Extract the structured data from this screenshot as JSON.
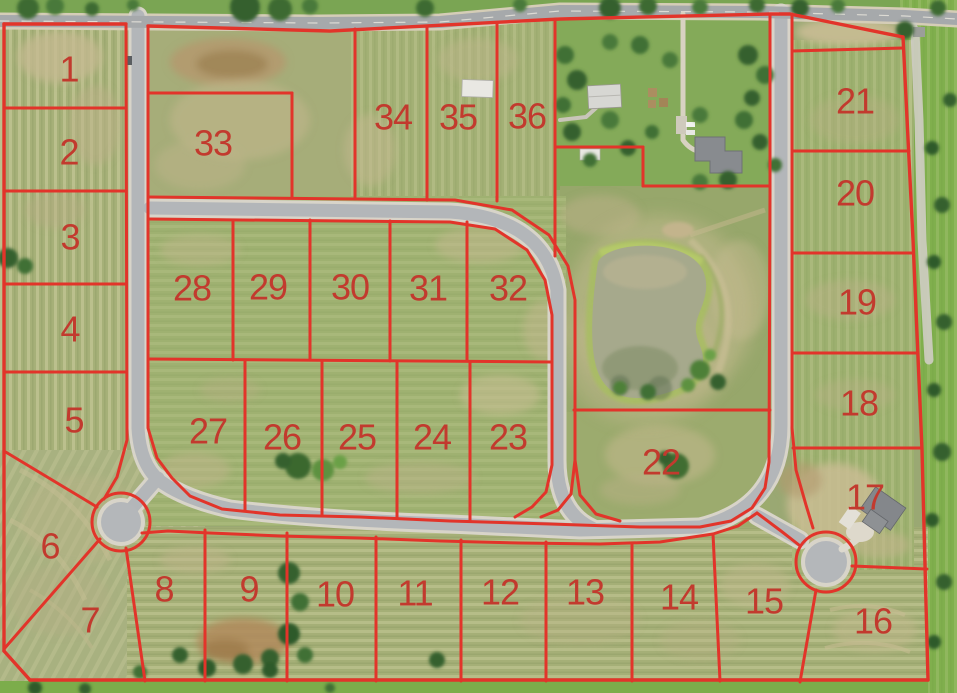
{
  "map": {
    "line_color": "#e2342a",
    "label_color": "#c23a2e",
    "label_font_px": 36,
    "lots": [
      {
        "number": "1",
        "x": 69,
        "y": 69
      },
      {
        "number": "2",
        "x": 69,
        "y": 152
      },
      {
        "number": "3",
        "x": 70,
        "y": 237
      },
      {
        "number": "4",
        "x": 70,
        "y": 329
      },
      {
        "number": "5",
        "x": 74,
        "y": 420
      },
      {
        "number": "6",
        "x": 50,
        "y": 546
      },
      {
        "number": "7",
        "x": 90,
        "y": 620
      },
      {
        "number": "8",
        "x": 164,
        "y": 589
      },
      {
        "number": "9",
        "x": 249,
        "y": 589
      },
      {
        "number": "10",
        "x": 335,
        "y": 594
      },
      {
        "number": "11",
        "x": 415,
        "y": 593
      },
      {
        "number": "12",
        "x": 500,
        "y": 592
      },
      {
        "number": "13",
        "x": 585,
        "y": 592
      },
      {
        "number": "14",
        "x": 679,
        "y": 597
      },
      {
        "number": "15",
        "x": 764,
        "y": 601
      },
      {
        "number": "16",
        "x": 873,
        "y": 621
      },
      {
        "number": "17",
        "x": 865,
        "y": 497
      },
      {
        "number": "18",
        "x": 859,
        "y": 403
      },
      {
        "number": "19",
        "x": 857,
        "y": 302
      },
      {
        "number": "20",
        "x": 855,
        "y": 193
      },
      {
        "number": "21",
        "x": 855,
        "y": 101
      },
      {
        "number": "22",
        "x": 661,
        "y": 462
      },
      {
        "number": "23",
        "x": 508,
        "y": 437
      },
      {
        "number": "24",
        "x": 432,
        "y": 437
      },
      {
        "number": "25",
        "x": 357,
        "y": 437
      },
      {
        "number": "26",
        "x": 282,
        "y": 437
      },
      {
        "number": "27",
        "x": 208,
        "y": 431
      },
      {
        "number": "28",
        "x": 192,
        "y": 288
      },
      {
        "number": "29",
        "x": 268,
        "y": 287
      },
      {
        "number": "30",
        "x": 350,
        "y": 287
      },
      {
        "number": "31",
        "x": 428,
        "y": 288
      },
      {
        "number": "32",
        "x": 508,
        "y": 288
      },
      {
        "number": "33",
        "x": 213,
        "y": 143
      },
      {
        "number": "34",
        "x": 393,
        "y": 117
      },
      {
        "number": "35",
        "x": 458,
        "y": 117
      },
      {
        "number": "36",
        "x": 527,
        "y": 116
      }
    ],
    "cul_de_sac_rings": [
      {
        "cx": 121,
        "cy": 522,
        "r": 29
      },
      {
        "cx": 826,
        "cy": 562,
        "r": 30
      }
    ],
    "plat_lines": [
      {
        "name": "boundary-top-west",
        "w": 3.4,
        "points": [
          [
            4,
            24
          ],
          [
            126,
            24
          ]
        ]
      },
      {
        "name": "boundary-top",
        "w": 3.4,
        "points": [
          [
            148,
            26
          ],
          [
            330,
            31
          ],
          [
            560,
            19
          ],
          [
            770,
            14
          ],
          [
            790,
            14
          ],
          [
            903,
            37
          ]
        ]
      },
      {
        "name": "boundary-east",
        "w": 3.4,
        "points": [
          [
            903,
            37
          ],
          [
            913,
            240
          ],
          [
            922,
            450
          ],
          [
            928,
            680
          ]
        ]
      },
      {
        "name": "boundary-bottom",
        "w": 3.4,
        "points": [
          [
            928,
            680
          ],
          [
            30,
            680
          ]
        ]
      },
      {
        "name": "boundary-southwest",
        "w": 3.4,
        "points": [
          [
            30,
            680
          ],
          [
            4,
            651
          ]
        ]
      },
      {
        "name": "boundary-west",
        "w": 3.4,
        "points": [
          [
            4,
            651
          ],
          [
            4,
            24
          ]
        ]
      },
      {
        "name": "west-road-west-side",
        "w": 3,
        "points": [
          [
            126,
            24
          ],
          [
            127,
            440
          ],
          [
            117,
            477
          ],
          [
            104,
            499
          ]
        ]
      },
      {
        "name": "road-corridor-inner",
        "w": 3,
        "points": [
          [
            148,
            26
          ],
          [
            148,
            428
          ],
          [
            157,
            458
          ],
          [
            172,
            478
          ],
          [
            190,
            496
          ],
          [
            222,
            509
          ],
          [
            280,
            515
          ],
          [
            360,
            517
          ],
          [
            450,
            521
          ],
          [
            550,
            524
          ],
          [
            640,
            527
          ],
          [
            700,
            527
          ],
          [
            731,
            521
          ],
          [
            752,
            508
          ],
          [
            765,
            488
          ],
          [
            769,
            462
          ],
          [
            770,
            190
          ],
          [
            770,
            14
          ]
        ]
      },
      {
        "name": "bottom-street-south-side",
        "w": 3,
        "points": [
          [
            142,
            533
          ],
          [
            168,
            531
          ],
          [
            210,
            533
          ],
          [
            280,
            536
          ],
          [
            360,
            538
          ],
          [
            440,
            541
          ],
          [
            520,
            543
          ],
          [
            600,
            544
          ],
          [
            660,
            542
          ],
          [
            713,
            534
          ],
          [
            738,
            526
          ],
          [
            757,
            513
          ]
        ]
      },
      {
        "name": "culdesac2-stem-southwest",
        "w": 3,
        "points": [
          [
            757,
            513
          ],
          [
            781,
            531
          ],
          [
            799,
            545
          ]
        ]
      },
      {
        "name": "east-road-east-side",
        "w": 3,
        "points": [
          [
            792,
            14
          ],
          [
            792,
            428
          ],
          [
            796,
            470
          ],
          [
            806,
            505
          ],
          [
            813,
            528
          ]
        ]
      },
      {
        "name": "loop-outer",
        "w": 3,
        "points": [
          [
            148,
            197
          ],
          [
            455,
            200
          ],
          [
            512,
            210
          ],
          [
            549,
            235
          ],
          [
            568,
            266
          ],
          [
            575,
            300
          ],
          [
            575,
            460
          ]
        ]
      },
      {
        "name": "loop-outer-east-curl",
        "w": 3,
        "points": [
          [
            575,
            460
          ],
          [
            580,
            495
          ],
          [
            596,
            514
          ],
          [
            620,
            521
          ]
        ]
      },
      {
        "name": "loop-outer-west-curl",
        "w": 3,
        "points": [
          [
            575,
            460
          ],
          [
            571,
            494
          ],
          [
            558,
            510
          ],
          [
            541,
            517
          ]
        ]
      },
      {
        "name": "loop-inner-block-edge",
        "w": 3,
        "points": [
          [
            148,
            219
          ],
          [
            450,
            222
          ],
          [
            495,
            229
          ],
          [
            527,
            250
          ],
          [
            545,
            280
          ],
          [
            552,
            315
          ],
          [
            552,
            465
          ],
          [
            546,
            492
          ],
          [
            532,
            507
          ],
          [
            515,
            517
          ]
        ]
      },
      {
        "name": "lot-1-2",
        "w": 3,
        "points": [
          [
            4,
            108
          ],
          [
            126,
            108
          ]
        ]
      },
      {
        "name": "lot-2-3",
        "w": 3,
        "points": [
          [
            4,
            191
          ],
          [
            126,
            191
          ]
        ]
      },
      {
        "name": "lot-3-4",
        "w": 3,
        "points": [
          [
            4,
            284
          ],
          [
            126,
            284
          ]
        ]
      },
      {
        "name": "lot-4-5",
        "w": 3,
        "points": [
          [
            4,
            372
          ],
          [
            126,
            372
          ]
        ]
      },
      {
        "name": "lot-5-6",
        "w": 3,
        "points": [
          [
            4,
            451
          ],
          [
            97,
            507
          ]
        ]
      },
      {
        "name": "lot-6-7",
        "w": 3,
        "points": [
          [
            4,
            649
          ],
          [
            100,
            539
          ]
        ]
      },
      {
        "name": "lot-7-8",
        "w": 3,
        "points": [
          [
            126,
            548
          ],
          [
            145,
            681
          ]
        ]
      },
      {
        "name": "lot-33-north",
        "w": 3,
        "points": [
          [
            148,
            93
          ],
          [
            292,
            93
          ]
        ]
      },
      {
        "name": "lot-33-east",
        "w": 3,
        "points": [
          [
            292,
            93
          ],
          [
            292,
            198
          ]
        ]
      },
      {
        "name": "lot-34-west",
        "w": 3,
        "points": [
          [
            355,
            29
          ],
          [
            355,
            199
          ]
        ]
      },
      {
        "name": "lot-34-35",
        "w": 3,
        "points": [
          [
            427,
            27
          ],
          [
            427,
            200
          ]
        ]
      },
      {
        "name": "lot-35-36",
        "w": 3,
        "points": [
          [
            497,
            24
          ],
          [
            497,
            201
          ]
        ]
      },
      {
        "name": "lot-36-east",
        "w": 3,
        "points": [
          [
            555,
            21
          ],
          [
            555,
            256
          ]
        ]
      },
      {
        "name": "farm-parcel-south-west",
        "w": 3,
        "points": [
          [
            555,
            147
          ],
          [
            643,
            147
          ]
        ]
      },
      {
        "name": "farm-parcel-jog",
        "w": 3,
        "points": [
          [
            643,
            147
          ],
          [
            643,
            186
          ]
        ]
      },
      {
        "name": "farm-parcel-south-east",
        "w": 3,
        "points": [
          [
            643,
            186
          ],
          [
            770,
            186
          ]
        ]
      },
      {
        "name": "lot-22-north",
        "w": 3,
        "points": [
          [
            574,
            410
          ],
          [
            770,
            410
          ]
        ]
      },
      {
        "name": "outlot-above-21",
        "w": 3,
        "points": [
          [
            792,
            51
          ],
          [
            903,
            48
          ]
        ]
      },
      {
        "name": "lot-21-20",
        "w": 3,
        "points": [
          [
            792,
            151
          ],
          [
            909,
            151
          ]
        ]
      },
      {
        "name": "lot-20-19",
        "w": 3,
        "points": [
          [
            792,
            253
          ],
          [
            913,
            253
          ]
        ]
      },
      {
        "name": "lot-19-18",
        "w": 3,
        "points": [
          [
            792,
            353
          ],
          [
            917,
            353
          ]
        ]
      },
      {
        "name": "lot-18-17",
        "w": 3,
        "points": [
          [
            793,
            448
          ],
          [
            922,
            448
          ]
        ]
      },
      {
        "name": "lot-17-16",
        "w": 3,
        "points": [
          [
            852,
            566
          ],
          [
            927,
            569
          ]
        ]
      },
      {
        "name": "lot-16-15",
        "w": 3,
        "points": [
          [
            816,
            590
          ],
          [
            800,
            682
          ]
        ]
      },
      {
        "name": "lot-8-9",
        "w": 3,
        "points": [
          [
            205,
            530
          ],
          [
            205,
            681
          ]
        ]
      },
      {
        "name": "lot-9-10",
        "w": 3,
        "points": [
          [
            287,
            533
          ],
          [
            287,
            681
          ]
        ]
      },
      {
        "name": "lot-10-11",
        "w": 3,
        "points": [
          [
            376,
            537
          ],
          [
            376,
            681
          ]
        ]
      },
      {
        "name": "lot-11-12",
        "w": 3,
        "points": [
          [
            461,
            540
          ],
          [
            461,
            681
          ]
        ]
      },
      {
        "name": "lot-12-13",
        "w": 3,
        "points": [
          [
            546,
            542
          ],
          [
            546,
            681
          ]
        ]
      },
      {
        "name": "lot-13-14",
        "w": 3,
        "points": [
          [
            632,
            543
          ],
          [
            632,
            681
          ]
        ]
      },
      {
        "name": "lot-14-15",
        "w": 3,
        "points": [
          [
            713,
            534
          ],
          [
            720,
            681
          ]
        ]
      },
      {
        "name": "block-mid-line",
        "w": 3,
        "points": [
          [
            148,
            359
          ],
          [
            552,
            362
          ]
        ]
      },
      {
        "name": "lot-28-29",
        "w": 3,
        "points": [
          [
            233,
            220
          ],
          [
            233,
            360
          ]
        ]
      },
      {
        "name": "lot-29-30",
        "w": 3,
        "points": [
          [
            310,
            220
          ],
          [
            310,
            360
          ]
        ]
      },
      {
        "name": "lot-30-31",
        "w": 3,
        "points": [
          [
            390,
            221
          ],
          [
            390,
            361
          ]
        ]
      },
      {
        "name": "lot-31-32",
        "w": 3,
        "points": [
          [
            467,
            222
          ],
          [
            467,
            361
          ]
        ]
      },
      {
        "name": "lot-27-26",
        "w": 3,
        "points": [
          [
            245,
            361
          ],
          [
            245,
            510
          ]
        ]
      },
      {
        "name": "lot-26-25",
        "w": 3,
        "points": [
          [
            322,
            361
          ],
          [
            322,
            515
          ]
        ]
      },
      {
        "name": "lot-25-24",
        "w": 3,
        "points": [
          [
            397,
            362
          ],
          [
            397,
            518
          ]
        ]
      },
      {
        "name": "lot-24-23",
        "w": 3,
        "points": [
          [
            470,
            362
          ],
          [
            470,
            520
          ]
        ]
      }
    ]
  }
}
